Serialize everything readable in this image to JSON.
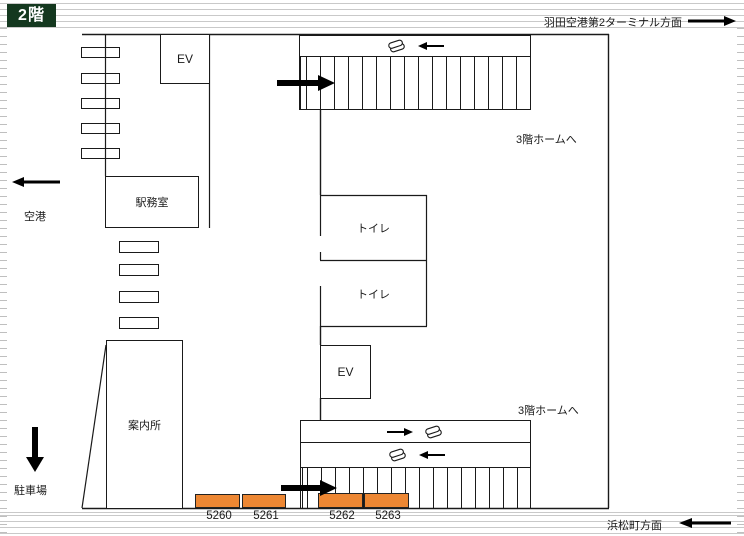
{
  "floor_badge": {
    "label": "2階"
  },
  "directions": {
    "haneda": {
      "label": "羽田空港第2ターミナル方面"
    },
    "hamamatsucho": {
      "label": "浜松町方面"
    },
    "airport": {
      "label": "空港"
    },
    "parking": {
      "label": "駐車場"
    }
  },
  "rooms": {
    "elevator_upper": {
      "label": "EV"
    },
    "elevator_lower": {
      "label": "EV"
    },
    "station_office": {
      "label": "駅務室"
    },
    "information_desk": {
      "label": "案内所"
    },
    "toilet_upper": {
      "label": "トイレ"
    },
    "toilet_lower": {
      "label": "トイレ"
    }
  },
  "stairs": {
    "to_3f_upper": {
      "label": "3階ホームへ"
    },
    "to_3f_lower": {
      "label": "3階ホームへ"
    }
  },
  "gates": [
    {
      "label": "5260"
    },
    {
      "label": "5261"
    },
    {
      "label": "5262"
    },
    {
      "label": "5263"
    }
  ],
  "colors": {
    "accent_orange": "#ED8733",
    "badge_green": "#14381F",
    "track_gray": "#C9C9C9"
  }
}
